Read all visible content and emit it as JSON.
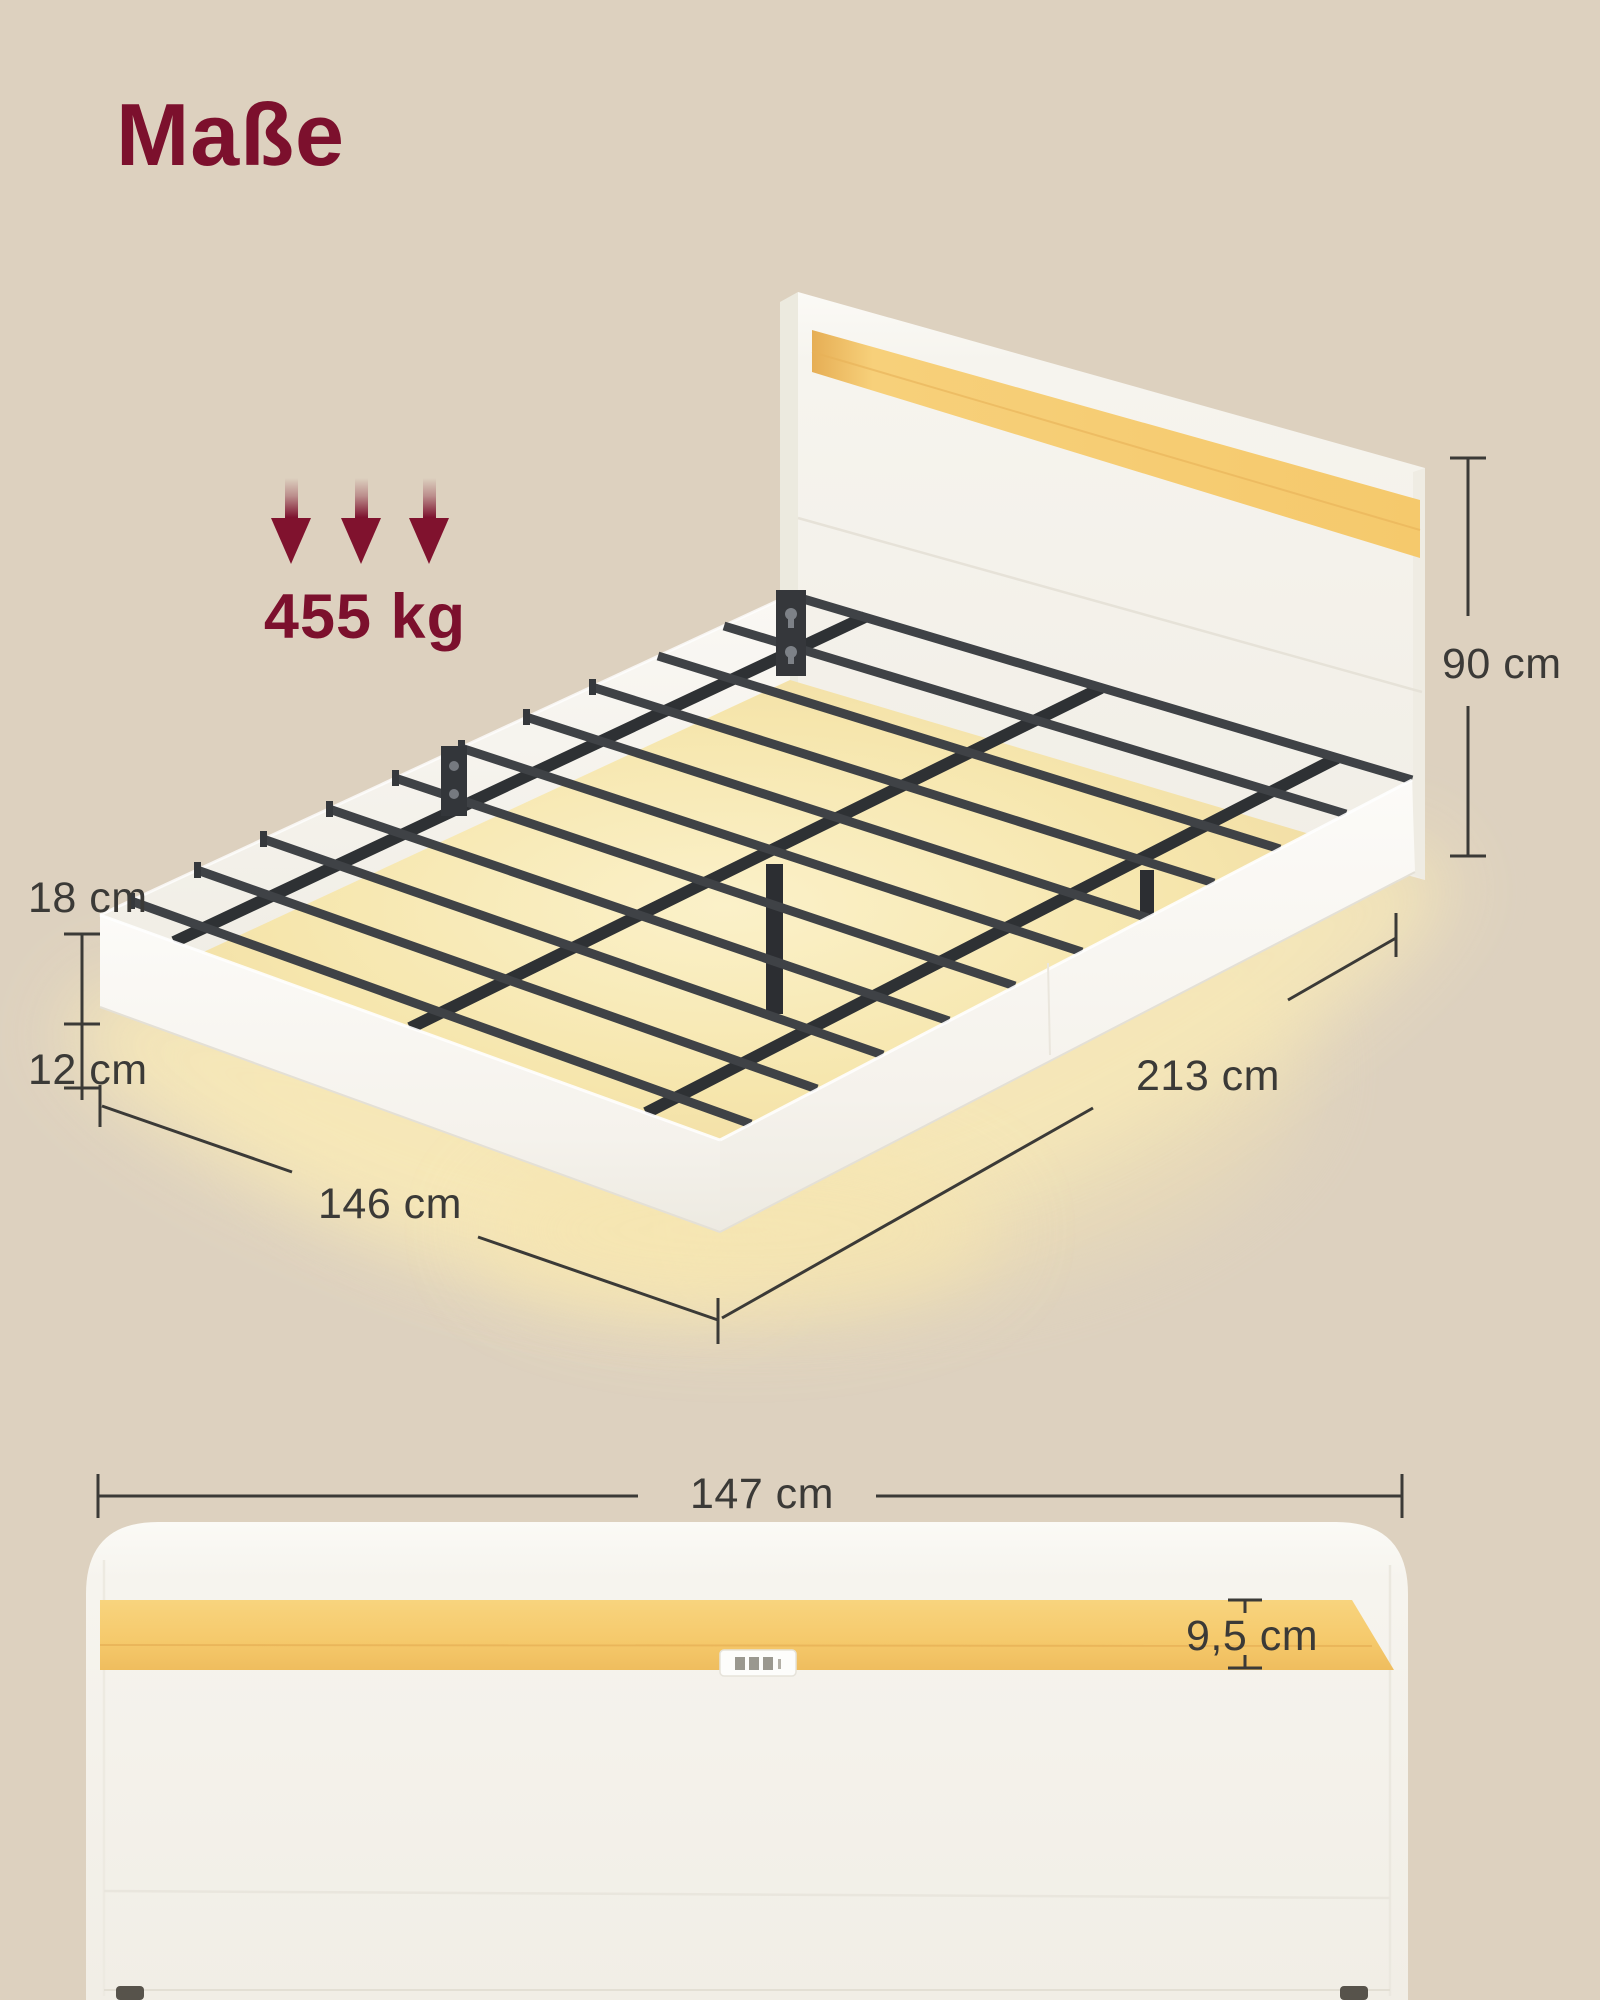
{
  "title": "Maße",
  "load_capacity": {
    "value": "455 kg",
    "arrows_icon": "down-arrow-icon",
    "arrow_count": 3
  },
  "bed_3d": {
    "height_label": "90 cm",
    "frame_height_label": "18 cm",
    "clearance_label": "12 cm",
    "width_label": "146 cm",
    "length_label": "213 cm"
  },
  "headboard_front": {
    "width_label": "147 cm",
    "led_recess_label": "9,5 cm"
  },
  "colors": {
    "background_beige": "#ddd1bf",
    "accent_maroon": "#7c102d",
    "dimension_ink": "#3b3a37",
    "frame_white": "#f7f5f0",
    "led_yellow": "#f6cc72",
    "metal_dark": "#3a3d41",
    "glow_warm": "#f7e7b6"
  }
}
